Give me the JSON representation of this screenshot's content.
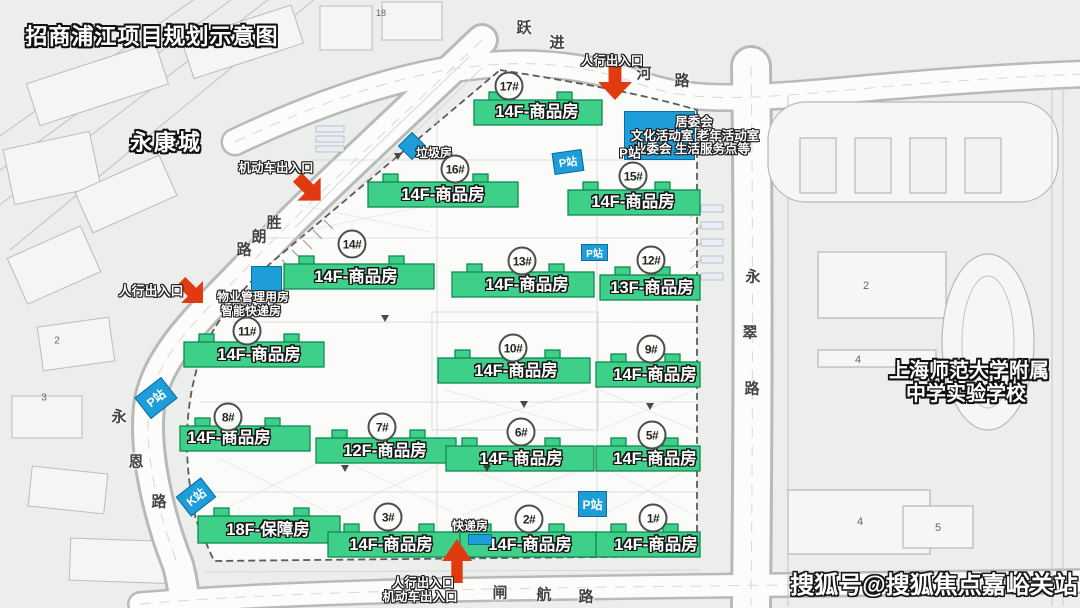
{
  "title": "招商浦江项目规划示意图",
  "watermark": "搜狐号@搜狐焦点嘉峪关站",
  "neighborhood_label": "永康城",
  "school": {
    "line1": "上海师范大学附属",
    "line2": "中学实验学校",
    "numbers": [
      "2",
      "4",
      "4",
      "5"
    ]
  },
  "context_numbers": {
    "top_block": "18",
    "left_a": "2",
    "left_b": "3"
  },
  "roads": {
    "yuejinhe": [
      "跃",
      "进",
      "河",
      "路"
    ],
    "shenglang": [
      "胜",
      "朗",
      "路"
    ],
    "yongcui": [
      "永",
      "翠",
      "路"
    ],
    "yongen": [
      "永",
      "恩",
      "路"
    ],
    "zhahang": [
      "闸",
      "航",
      "路"
    ]
  },
  "entrances": {
    "pedestrian": "人行出入口",
    "vehicle": "机动车出入口"
  },
  "stations": {
    "p": "P站",
    "k": "K站"
  },
  "facilities": {
    "trash": "垃圾房",
    "delivery": "快递房",
    "property": [
      "物业管理用房",
      "智能快递房"
    ],
    "community": [
      "居委会",
      "文化活动室 老年活动室",
      "业委会 生活服务点等"
    ]
  },
  "buildings": [
    {
      "unit": "17#",
      "type": "14F-商品房"
    },
    {
      "unit": "16#",
      "type": "14F-商品房"
    },
    {
      "unit": "15#",
      "type": "14F-商品房"
    },
    {
      "unit": "14#",
      "type": "14F-商品房"
    },
    {
      "unit": "13#",
      "type": "14F-商品房"
    },
    {
      "unit": "12#",
      "type": "13F-商品房"
    },
    {
      "unit": "11#",
      "type": "14F-商品房"
    },
    {
      "unit": "10#",
      "type": "14F-商品房"
    },
    {
      "unit": "9#",
      "type": "14F-商品房"
    },
    {
      "unit": "8#",
      "type": "14F-商品房"
    },
    {
      "unit": "7#",
      "type": "12F-商品房"
    },
    {
      "unit": "6#",
      "type": "14F-商品房"
    },
    {
      "unit": "5#",
      "type": "14F-商品房"
    },
    {
      "unit": "3#",
      "type": "14F-商品房"
    },
    {
      "unit": "2#",
      "type": "14F-商品房"
    },
    {
      "unit": "1#",
      "type": "14F-商品房"
    },
    {
      "unit": "",
      "type": "18F-保障房"
    }
  ],
  "colors": {
    "building_green": "#3ed089",
    "station_blue": "#1e9ed8",
    "entrance_red": "#e23a10"
  }
}
